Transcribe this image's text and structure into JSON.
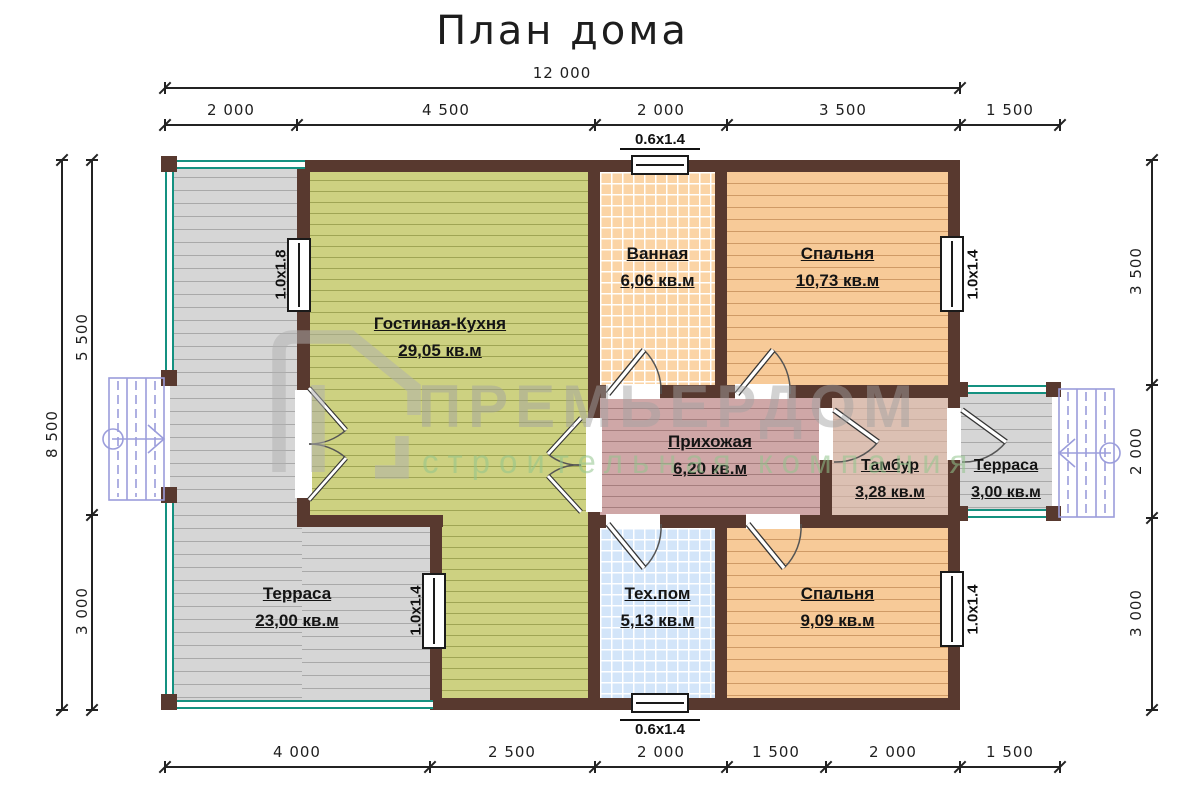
{
  "title": "План дома",
  "watermark": {
    "brand": "ПРЕМЬЕРДОМ",
    "subtitle": "строительная компания"
  },
  "rooms": {
    "living": {
      "name": "Гостиная-Кухня",
      "area": "29,05 кв.м"
    },
    "bath": {
      "name": "Ванная",
      "area": "6,06 кв.м"
    },
    "bedroom1": {
      "name": "Спальня",
      "area": "10,73 кв.м"
    },
    "hall": {
      "name": "Прихожая",
      "area": "6,20 кв.м"
    },
    "tambour": {
      "name": "Тамбур",
      "area": "3,28 кв.м"
    },
    "terrace_small": {
      "name": "Терраса",
      "area": "3,00 кв.м"
    },
    "terrace_big": {
      "name": "Терраса",
      "area": "23,00 кв.м"
    },
    "tech": {
      "name": "Тех.пом",
      "area": "5,13 кв.м"
    },
    "bedroom2": {
      "name": "Спальня",
      "area": "9,09 кв.м"
    }
  },
  "windows": {
    "top": "0.6x1.4",
    "bottom": "0.6x1.4",
    "left": "1.0x1.8",
    "inner": "1.0x1.4",
    "right_top": "1.0x1.4",
    "right_bottom": "1.0x1.4"
  },
  "dims": {
    "top_total": "12 000",
    "top": [
      "2 000",
      "4 500",
      "2 000",
      "3 500",
      "1 500"
    ],
    "bottom": [
      "4 000",
      "2 500",
      "2 000",
      "1 500",
      "2 000",
      "1 500"
    ],
    "left_total": "8 500",
    "left": [
      "5 500",
      "3 000"
    ],
    "right": [
      "3 500",
      "2 000",
      "3 000"
    ]
  },
  "colors": {
    "wall": "#58392f",
    "terrace": "#d6d6d6",
    "living": "#cdd181",
    "bedroom": "#f7ca98",
    "bath": "#fbd4a6",
    "tech": "#d3e5f9",
    "hall": "#cfa7a7",
    "tambour": "#dcc0b3",
    "railing": "#149180",
    "stairs": "#9b9ddb",
    "watermark_gray": "#a0a0a0",
    "watermark_green": "#92c48c"
  }
}
